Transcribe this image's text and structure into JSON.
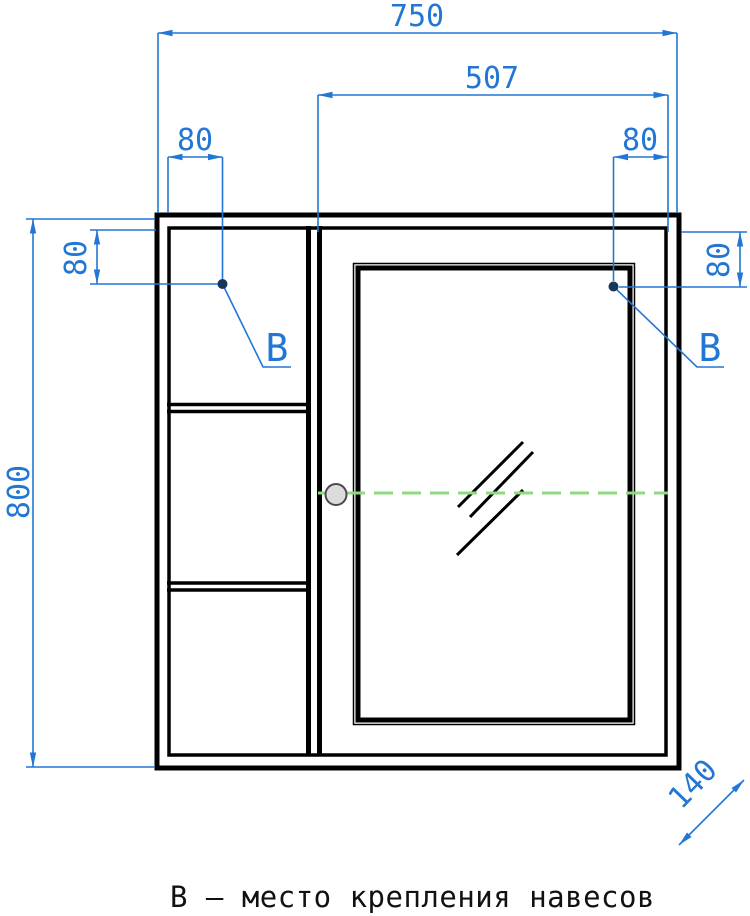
{
  "drawing": {
    "caption": "В – место крепления навесов",
    "dimensions": {
      "overall_width": "750",
      "mount_span_right": "507",
      "mount_inset_top_left": "80",
      "mount_inset_top_right": "80",
      "mount_drop_left": "80",
      "mount_drop_right": "80",
      "overall_height": "800",
      "depth": "140"
    },
    "mount_labels": {
      "left": "В",
      "right": "В"
    },
    "colors": {
      "dimension_blue": "#2277d4",
      "centerline_green": "#8fd982",
      "line_black": "#000000",
      "mount_dot_navy": "#16365c",
      "handle_gray": "#dcdcdc"
    }
  }
}
